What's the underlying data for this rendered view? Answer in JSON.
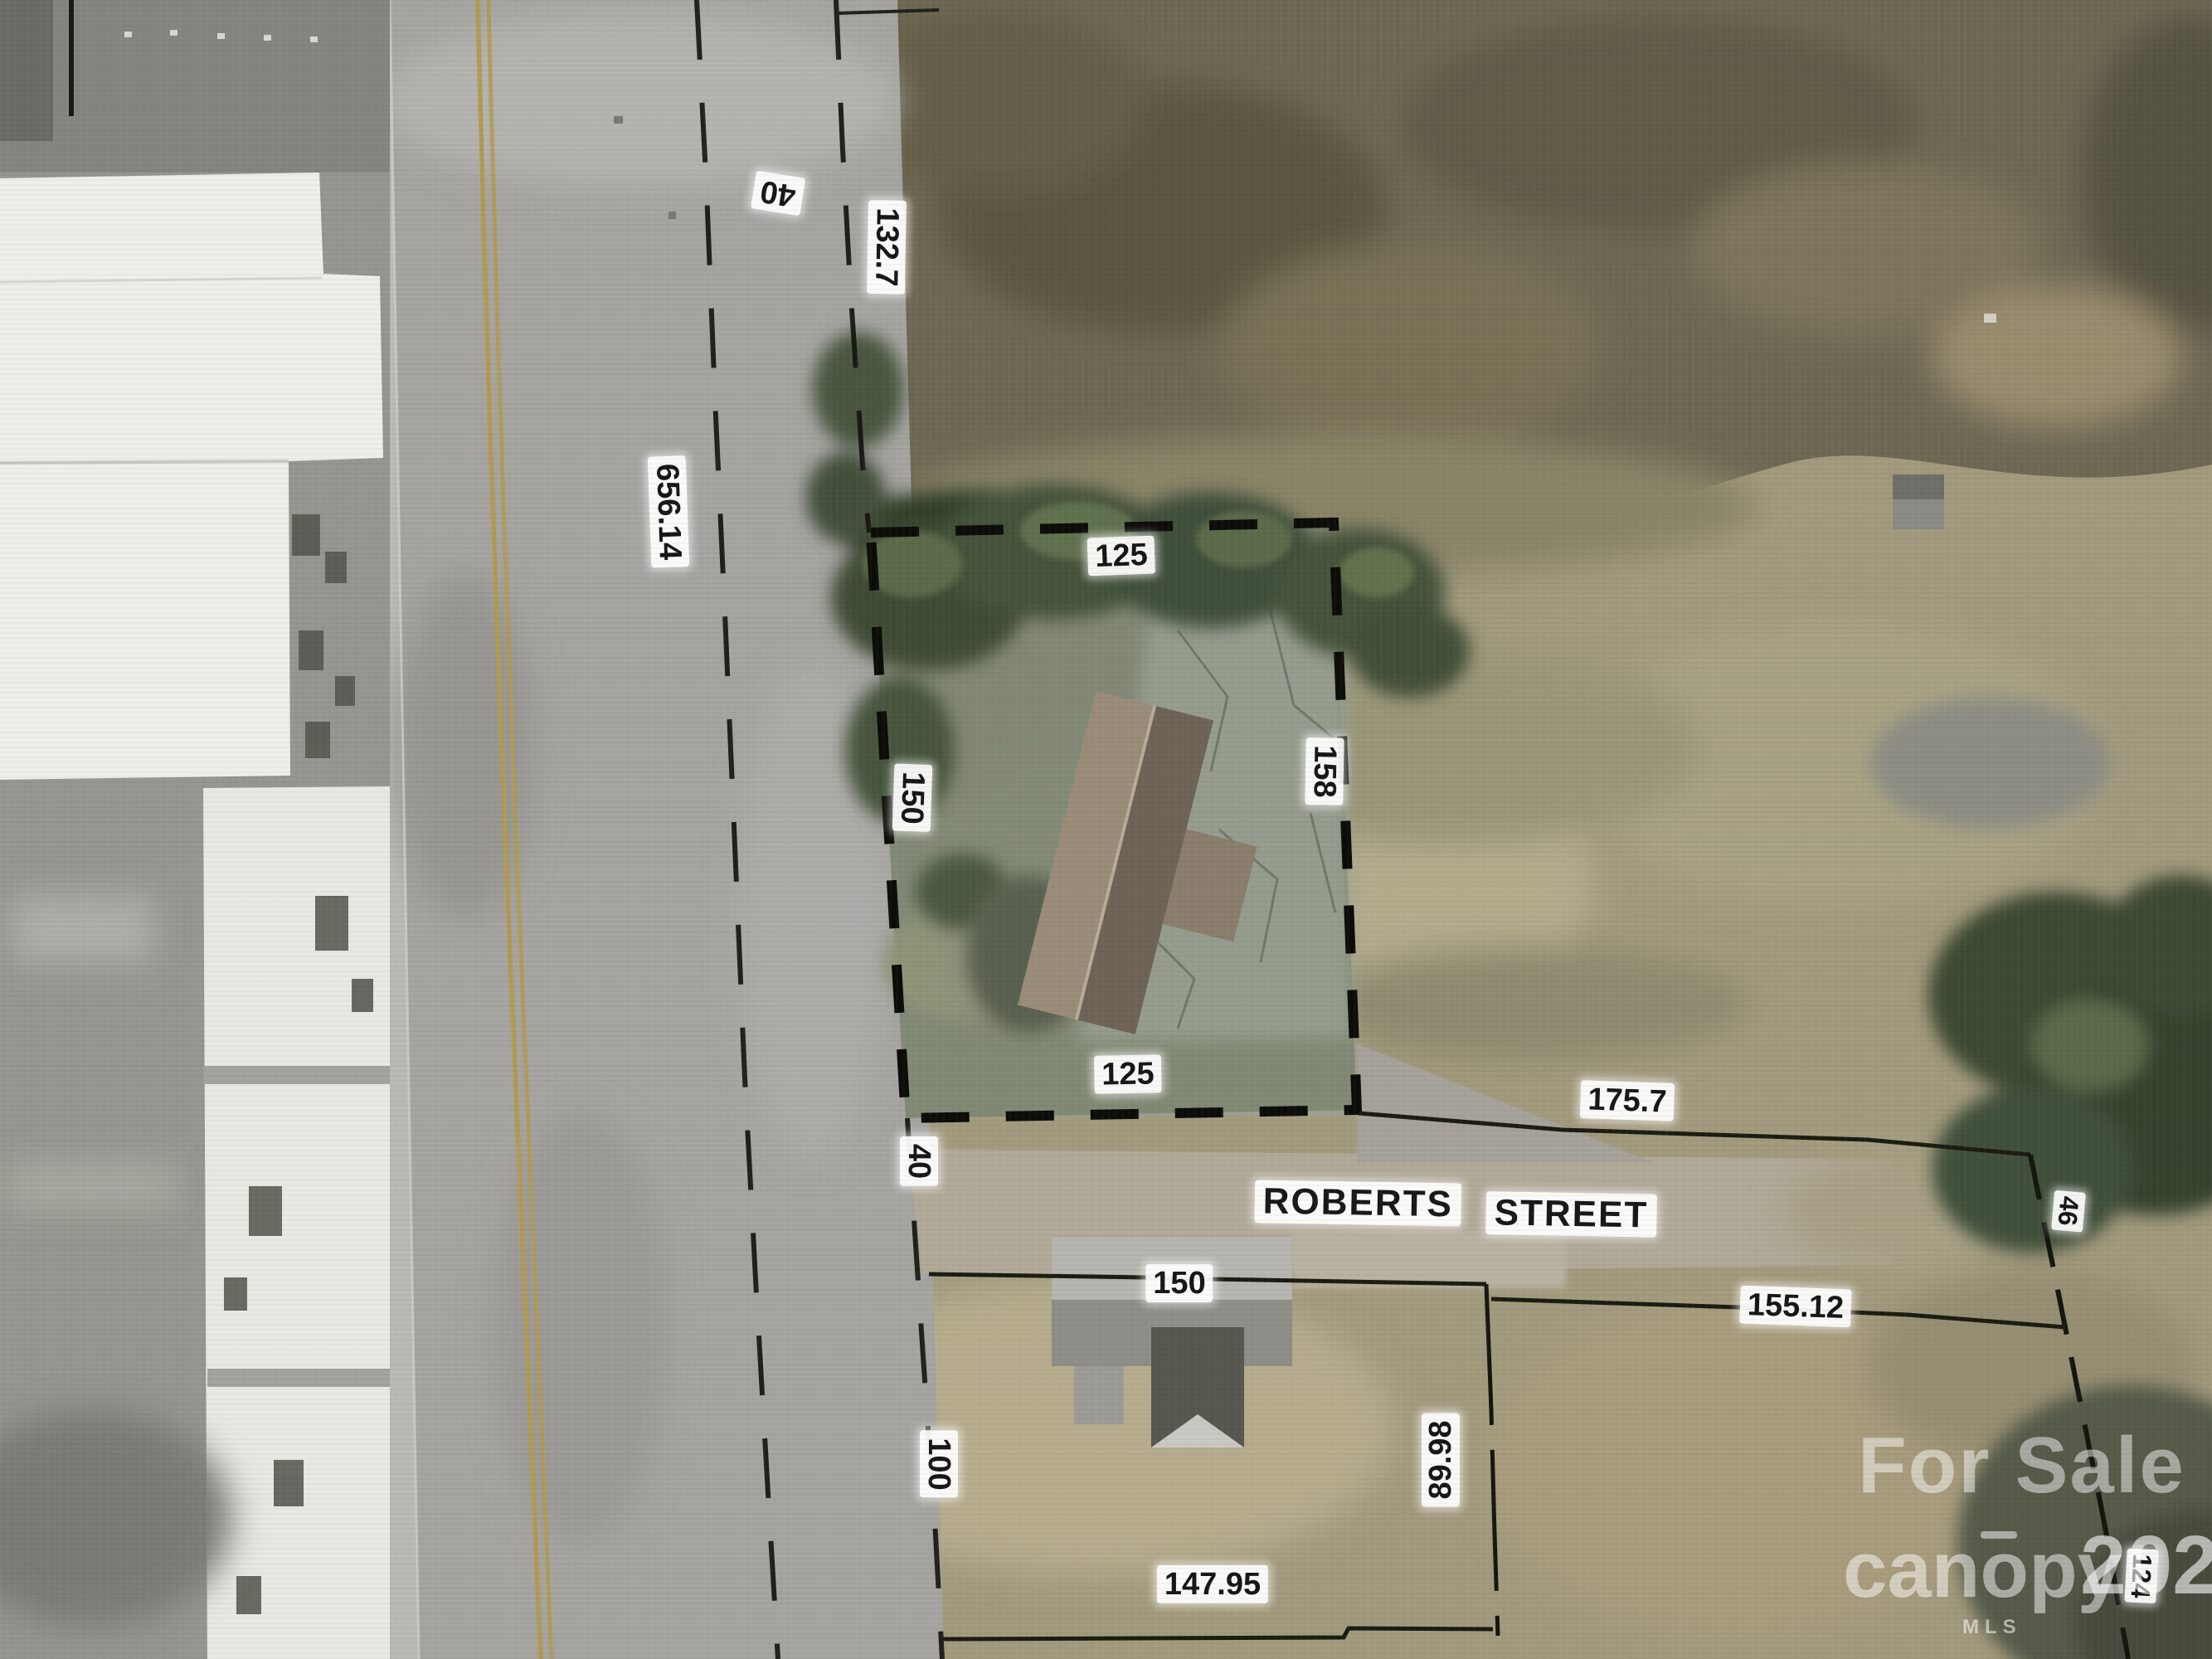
{
  "map": {
    "street": {
      "word1": "ROBERTS",
      "word2": "STREET"
    },
    "dimensions": {
      "road_width_top": "40",
      "road_frontage_east": "132.7",
      "road_length_west": "656.14",
      "parcel_north": "125",
      "parcel_west": "150",
      "parcel_east": "158",
      "parcel_south": "125",
      "road_width_bottom": "40",
      "lot_line_175": "175.7",
      "lot_line_46": "46",
      "lot_line_150": "150",
      "lot_line_155": "155.12",
      "lot_line_100": "100",
      "lot_line_89": "89.98",
      "lot_line_147": "147.95",
      "lot_line_124": "124"
    },
    "watermark": {
      "for_sale": "For Sale",
      "brand": "canopy",
      "year": "2023",
      "mls": "MLS"
    },
    "colors": {
      "parcel_boundary": "#0c0c08",
      "label_background": "#ffffff",
      "label_text": "#161616",
      "road_center_line": "#b29a54",
      "field_brush": "#6e6853",
      "field_grass": "#a29a7d",
      "tree_canopy": "#3f4c35",
      "road_asphalt": "#a5a4a0",
      "building_roof": "#efeee8"
    }
  }
}
